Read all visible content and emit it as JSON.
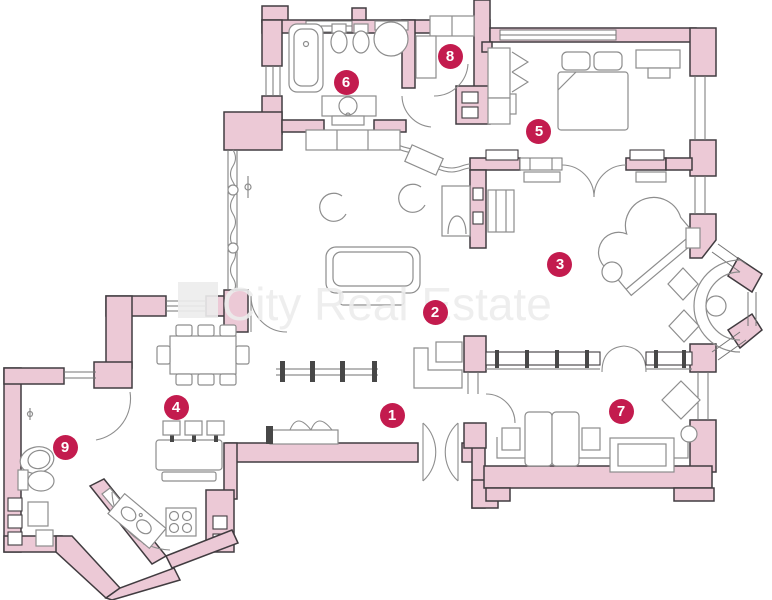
{
  "floorplan": {
    "watermark": {
      "text": "City Real Estate"
    },
    "colors": {
      "background": "#ffffff",
      "wall_fill": "#ecc9d6",
      "wall_stroke": "#413c40",
      "line_gray": "#8d8d8d",
      "window_gray": "#757575",
      "marker_fill": "#c31b4e",
      "marker_text": "#ffffff",
      "watermark_gray": "#ededed"
    },
    "markers": [
      {
        "label": "1",
        "x": 392,
        "y": 415
      },
      {
        "label": "2",
        "x": 435,
        "y": 312
      },
      {
        "label": "3",
        "x": 560,
        "y": 264
      },
      {
        "label": "4",
        "x": 176,
        "y": 407
      },
      {
        "label": "5",
        "x": 539,
        "y": 131
      },
      {
        "label": "6",
        "x": 346,
        "y": 82
      },
      {
        "label": "7",
        "x": 621,
        "y": 411
      },
      {
        "label": "8",
        "x": 450,
        "y": 56
      },
      {
        "label": "9",
        "x": 65,
        "y": 447
      }
    ]
  }
}
